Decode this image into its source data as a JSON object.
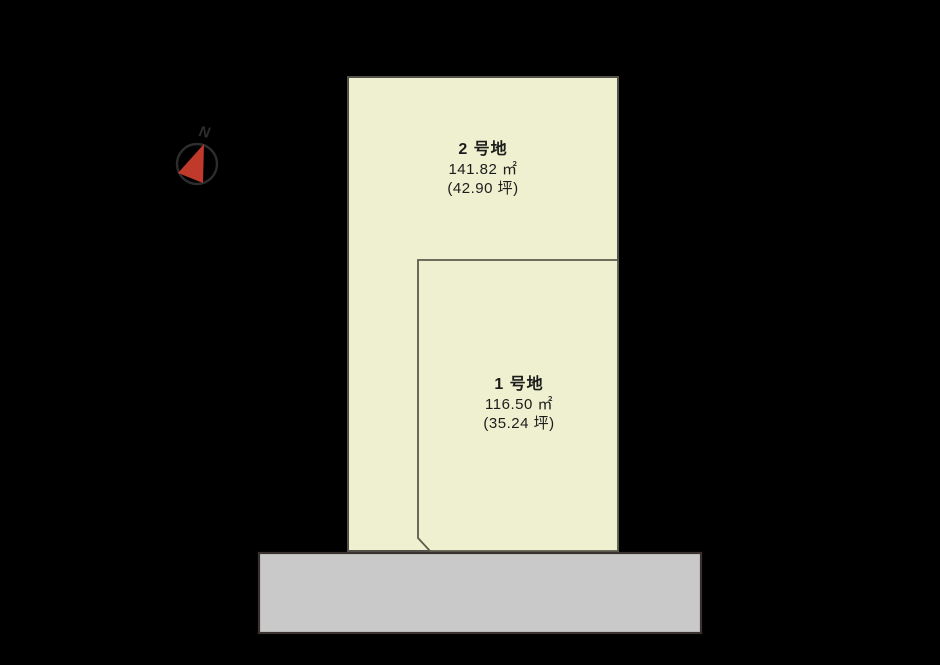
{
  "canvas": {
    "background": "#000000",
    "text_color": "#1c1c1c"
  },
  "compass": {
    "label": "N",
    "ring_color": "#2d2d2d",
    "needle_color": "#c03a2b",
    "label_color": "#2d2d2d"
  },
  "plots": [
    {
      "name": "2 号地",
      "area_m2": "141.82 ㎡",
      "area_tsubo": "(42.90 坪)",
      "fill": "#eef0cf",
      "border": "#52514a"
    },
    {
      "name": "1 号地",
      "area_m2": "116.50 ㎡",
      "area_tsubo": "(35.24 坪)",
      "fill": "#eef0cf",
      "border": "#5c5b4e"
    }
  ],
  "road": {
    "fill": "#c9c9c9",
    "border": "#3a3231"
  }
}
